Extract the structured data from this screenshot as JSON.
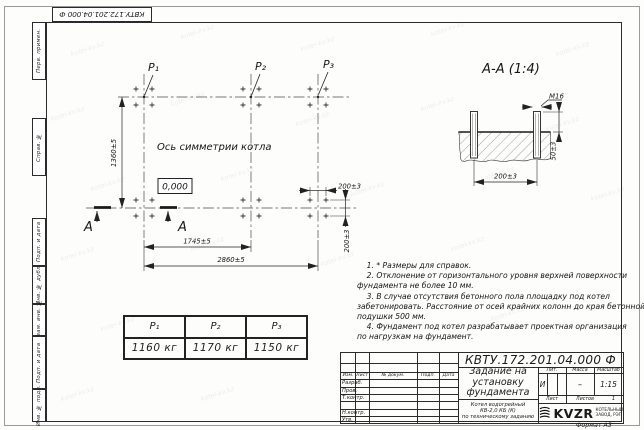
{
  "doc_number": "КВТУ.172.201.04.000 Ф",
  "watermark": "kotel-kv.kz",
  "margin_labels": [
    "Перв. примен.",
    "Справ. №",
    "Подп. и дата",
    "Инв. № дубл.",
    "Взам. инв. №",
    "Подп. и дата",
    "Инв. № подл."
  ],
  "plan": {
    "p1_label": "P₁",
    "p2_label": "P₂",
    "p3_label": "P₃",
    "axis_label": "Ось симметрии котла",
    "elevation": "0,000",
    "dim_height": "1360±5",
    "dim_span1": "1745±5",
    "dim_span2": "2860±5",
    "dim_bolt_x": "200±3",
    "dim_bolt_y": "200±3",
    "section_letter": "А"
  },
  "section": {
    "title": "А-А (1:4)",
    "bolt_thread": "М16",
    "dim_protrusion": "50±3",
    "dim_bolt_spacing": "200±3"
  },
  "notes": "    1. * Размеры для справок.\n    2. Отклонение от горизонтального уровня верхней поверхности\nфундамента не более 10 мм.\n    3. В случае отсутствия бетонного пола площадку под котел\nзабетонировать. Расстояние от осей крайних колонн до края бетонной\nподушки 500 мм.\n    4. Фундамент под котел разрабатывает проектная организация\nпо нагрузкам на фундамент.",
  "load_table": {
    "headers": [
      "P₁",
      "P₂",
      "P₃"
    ],
    "values": [
      "1160 кг",
      "1170 кг",
      "1150 кг"
    ]
  },
  "title_block": {
    "doc_number": "КВТУ.172.201.04.000  Ф",
    "title": "Задание на\nустановку\nфундамента",
    "subtitle": "Котел водогрейный\nКВ-2,0 КБ (К)\nпо техническому заданию",
    "header_cols": [
      "Изм.",
      "Лист",
      "№ докум.",
      "Подп.",
      "Дата"
    ],
    "sign_rows": [
      "Разраб.",
      "Пров.",
      "Т.контр.",
      "Н.контр.",
      "Утв."
    ],
    "lit_header": "Лит.",
    "mass_header": "Масса",
    "scale_header": "Масштаб",
    "lit_value": "И",
    "mass_value": "–",
    "scale_value": "1:15",
    "sheet_label": "Лист",
    "sheets_label": "Листов",
    "sheets_value": "1",
    "logo_text": "KVZR",
    "logo_sub": "КОТЕЛЬНЫЙ\nЗАВОД, РЭП",
    "format_label": "Формат А3"
  },
  "colors": {
    "line": "#2b2b2b",
    "paper": "#fdfdfc"
  }
}
